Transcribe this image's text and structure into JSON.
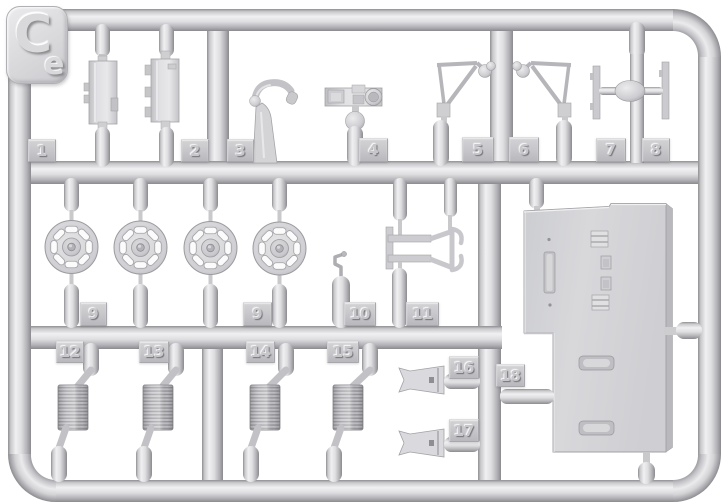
{
  "sprue": {
    "gate_label": {
      "big": "C",
      "small": "e"
    },
    "tabs": [
      {
        "label": "1"
      },
      {
        "label": "2"
      },
      {
        "label": "3"
      },
      {
        "label": "4"
      },
      {
        "label": "5"
      },
      {
        "label": "6"
      },
      {
        "label": "7"
      },
      {
        "label": "8"
      },
      {
        "label": "9"
      },
      {
        "label": "9"
      },
      {
        "label": "10"
      },
      {
        "label": "11"
      },
      {
        "label": "12"
      },
      {
        "label": "13"
      },
      {
        "label": "14"
      },
      {
        "label": "15"
      },
      {
        "label": "16"
      },
      {
        "label": "17"
      },
      {
        "label": "18"
      }
    ],
    "colors": {
      "background": "#ffffff",
      "plastic_base": "#d6d6d9",
      "plastic_highlight": "#f0f0f2",
      "plastic_shadow": "#8e8e92",
      "tab_face": "#c8c8cc"
    },
    "parts": [
      {
        "id": "1",
        "shape": "stowage-box"
      },
      {
        "id": "2",
        "shape": "stowage-box-ribbed"
      },
      {
        "id": "3",
        "shape": "periscope-hook"
      },
      {
        "id": "4",
        "shape": "instrument-bar-with-disc"
      },
      {
        "id": "5",
        "shape": "antenna-frame-left"
      },
      {
        "id": "6",
        "shape": "antenna-frame-right"
      },
      {
        "id": "7-8",
        "shape": "cross-mount-with-plates"
      },
      {
        "id": "9",
        "shape": "road-wheel",
        "count": 4
      },
      {
        "id": "10",
        "shape": "crank-cylinder"
      },
      {
        "id": "11",
        "shape": "bracket-frame-clamp"
      },
      {
        "id": "12-15",
        "shape": "coil-spring",
        "count": 4
      },
      {
        "id": "16-17",
        "shape": "notched-wedge",
        "count": 2
      },
      {
        "id": "18",
        "shape": "large-hull-plate"
      }
    ]
  }
}
